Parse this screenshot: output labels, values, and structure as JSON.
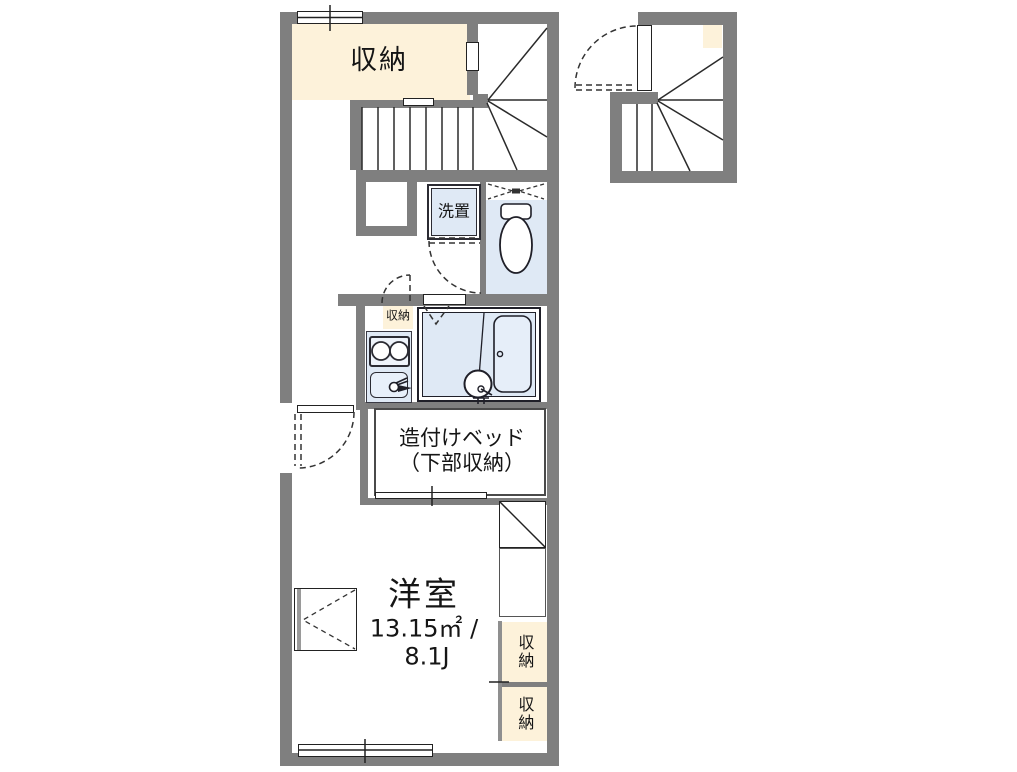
{
  "plan": {
    "title": "apartment-floorplan",
    "labels": {
      "storage_top": "収納",
      "washer": "洗置",
      "storage_small": "収納",
      "bed_line1": "造付けベッド",
      "bed_line2": "（下部収納）",
      "room_name": "洋室",
      "room_area": "13.15㎡ /",
      "room_size": "8.1J",
      "closet_upper": "収納",
      "closet_lower": "収納"
    },
    "colors": {
      "wall": "#7f7f7f",
      "storage_fill": "#fdf2da",
      "wet_area_fill": "#dfe9f5",
      "linework": "#2b2b2b"
    }
  }
}
